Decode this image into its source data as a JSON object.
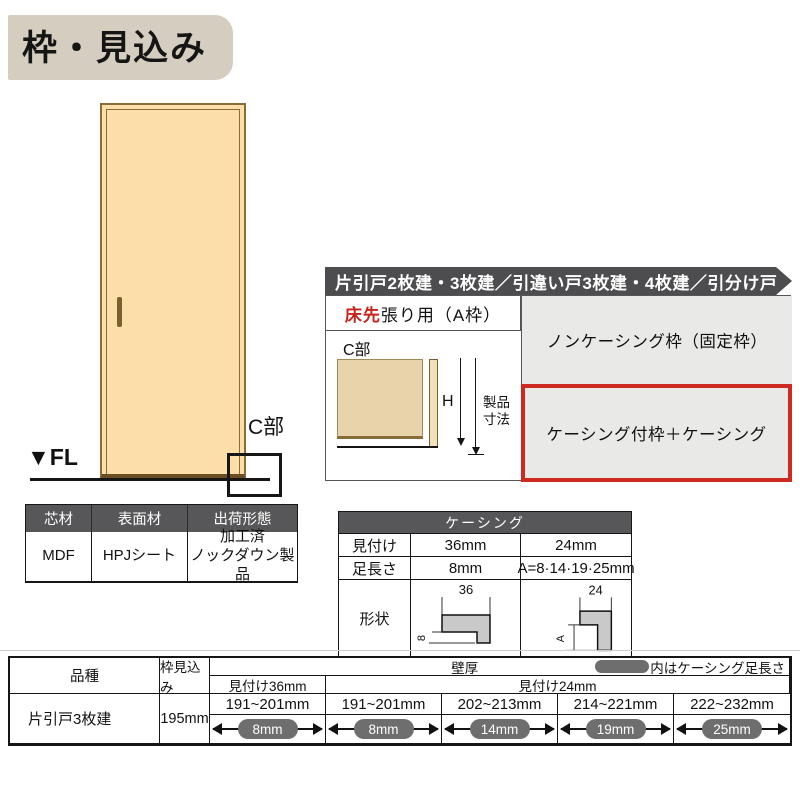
{
  "colors": {
    "accent_red": "#cf2a21",
    "header_dark_gray": "#57575a",
    "banner_gray": "#4d4d50",
    "option_cell_gray": "#e9e9e8",
    "pill_gray": "#6e6e6e",
    "title_badge_beige": "#d5cec0",
    "door_fill": "#fcdfa8",
    "door_border": "#8a6c3a",
    "diagram_tan": "#e7d4ab",
    "shape_gray": "#c9c9c9"
  },
  "title": {
    "text": "枠・見込み"
  },
  "door_figure": {
    "fl_label": "▼FL",
    "c_part_label": "C部"
  },
  "material_table": {
    "headers": [
      "芯材",
      "表面材",
      "出荷形態"
    ],
    "values": [
      "MDF",
      "HPJシート",
      "加工済\nノックダウン製品"
    ]
  },
  "type_banner": {
    "text": "片引戸2枚建・3枚建／引違い戸3枚建・4枚建／引分け戸"
  },
  "frame_section": {
    "header_red": "床先",
    "header_rest": "張り用（A枠）",
    "diagram": {
      "c_label": "C部",
      "h_dim": "H",
      "product_dim": "製品\n寸法"
    },
    "options": [
      {
        "label": "ノンケーシング枠（固定枠）",
        "selected": false
      },
      {
        "label": "ケーシング付枠＋ケーシング",
        "selected": true
      }
    ]
  },
  "casing_table": {
    "title": "ケーシング",
    "rows": [
      {
        "label": "見付け",
        "col36": "36mm",
        "col24": "24mm"
      },
      {
        "label": "足長さ",
        "col36": "8mm",
        "col24": "A=8·14·19·25mm"
      }
    ],
    "shape_label": "形状",
    "shape36": {
      "top_dim": "36",
      "side_dim": "8"
    },
    "shape24": {
      "top_dim": "24",
      "side_dim": "A"
    }
  },
  "bottom_table": {
    "kind_header": "品種",
    "depth_header": "枠見込み",
    "wall_header": "壁厚",
    "legend_text": "内はケーシング足長さ",
    "sub_headers": {
      "col36": "見付け36mm",
      "col24": "見付け24mm"
    },
    "row": {
      "kind": "片引戸3枚建",
      "depth": "195mm",
      "cells": [
        {
          "range": "191~201mm",
          "leg": "8mm"
        },
        {
          "range": "191~201mm",
          "leg": "8mm"
        },
        {
          "range": "202~213mm",
          "leg": "14mm"
        },
        {
          "range": "214~221mm",
          "leg": "19mm"
        },
        {
          "range": "222~232mm",
          "leg": "25mm"
        }
      ]
    }
  }
}
